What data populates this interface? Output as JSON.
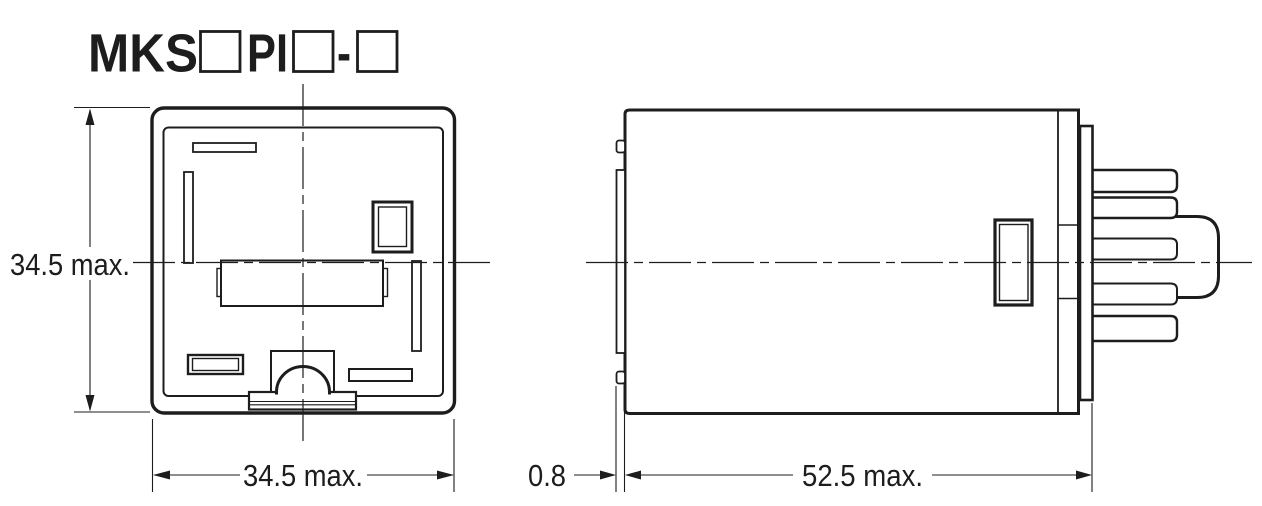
{
  "title": {
    "model_prefix": "MKS",
    "model_mid": "PI",
    "separator": "-"
  },
  "front_view": {
    "height_label": "34.5 max.",
    "width_label": "34.5 max."
  },
  "side_view": {
    "flange_label": "0.8",
    "depth_label": "52.5 max."
  },
  "colors": {
    "line": "#1d1d1d",
    "background": "#ffffff"
  }
}
